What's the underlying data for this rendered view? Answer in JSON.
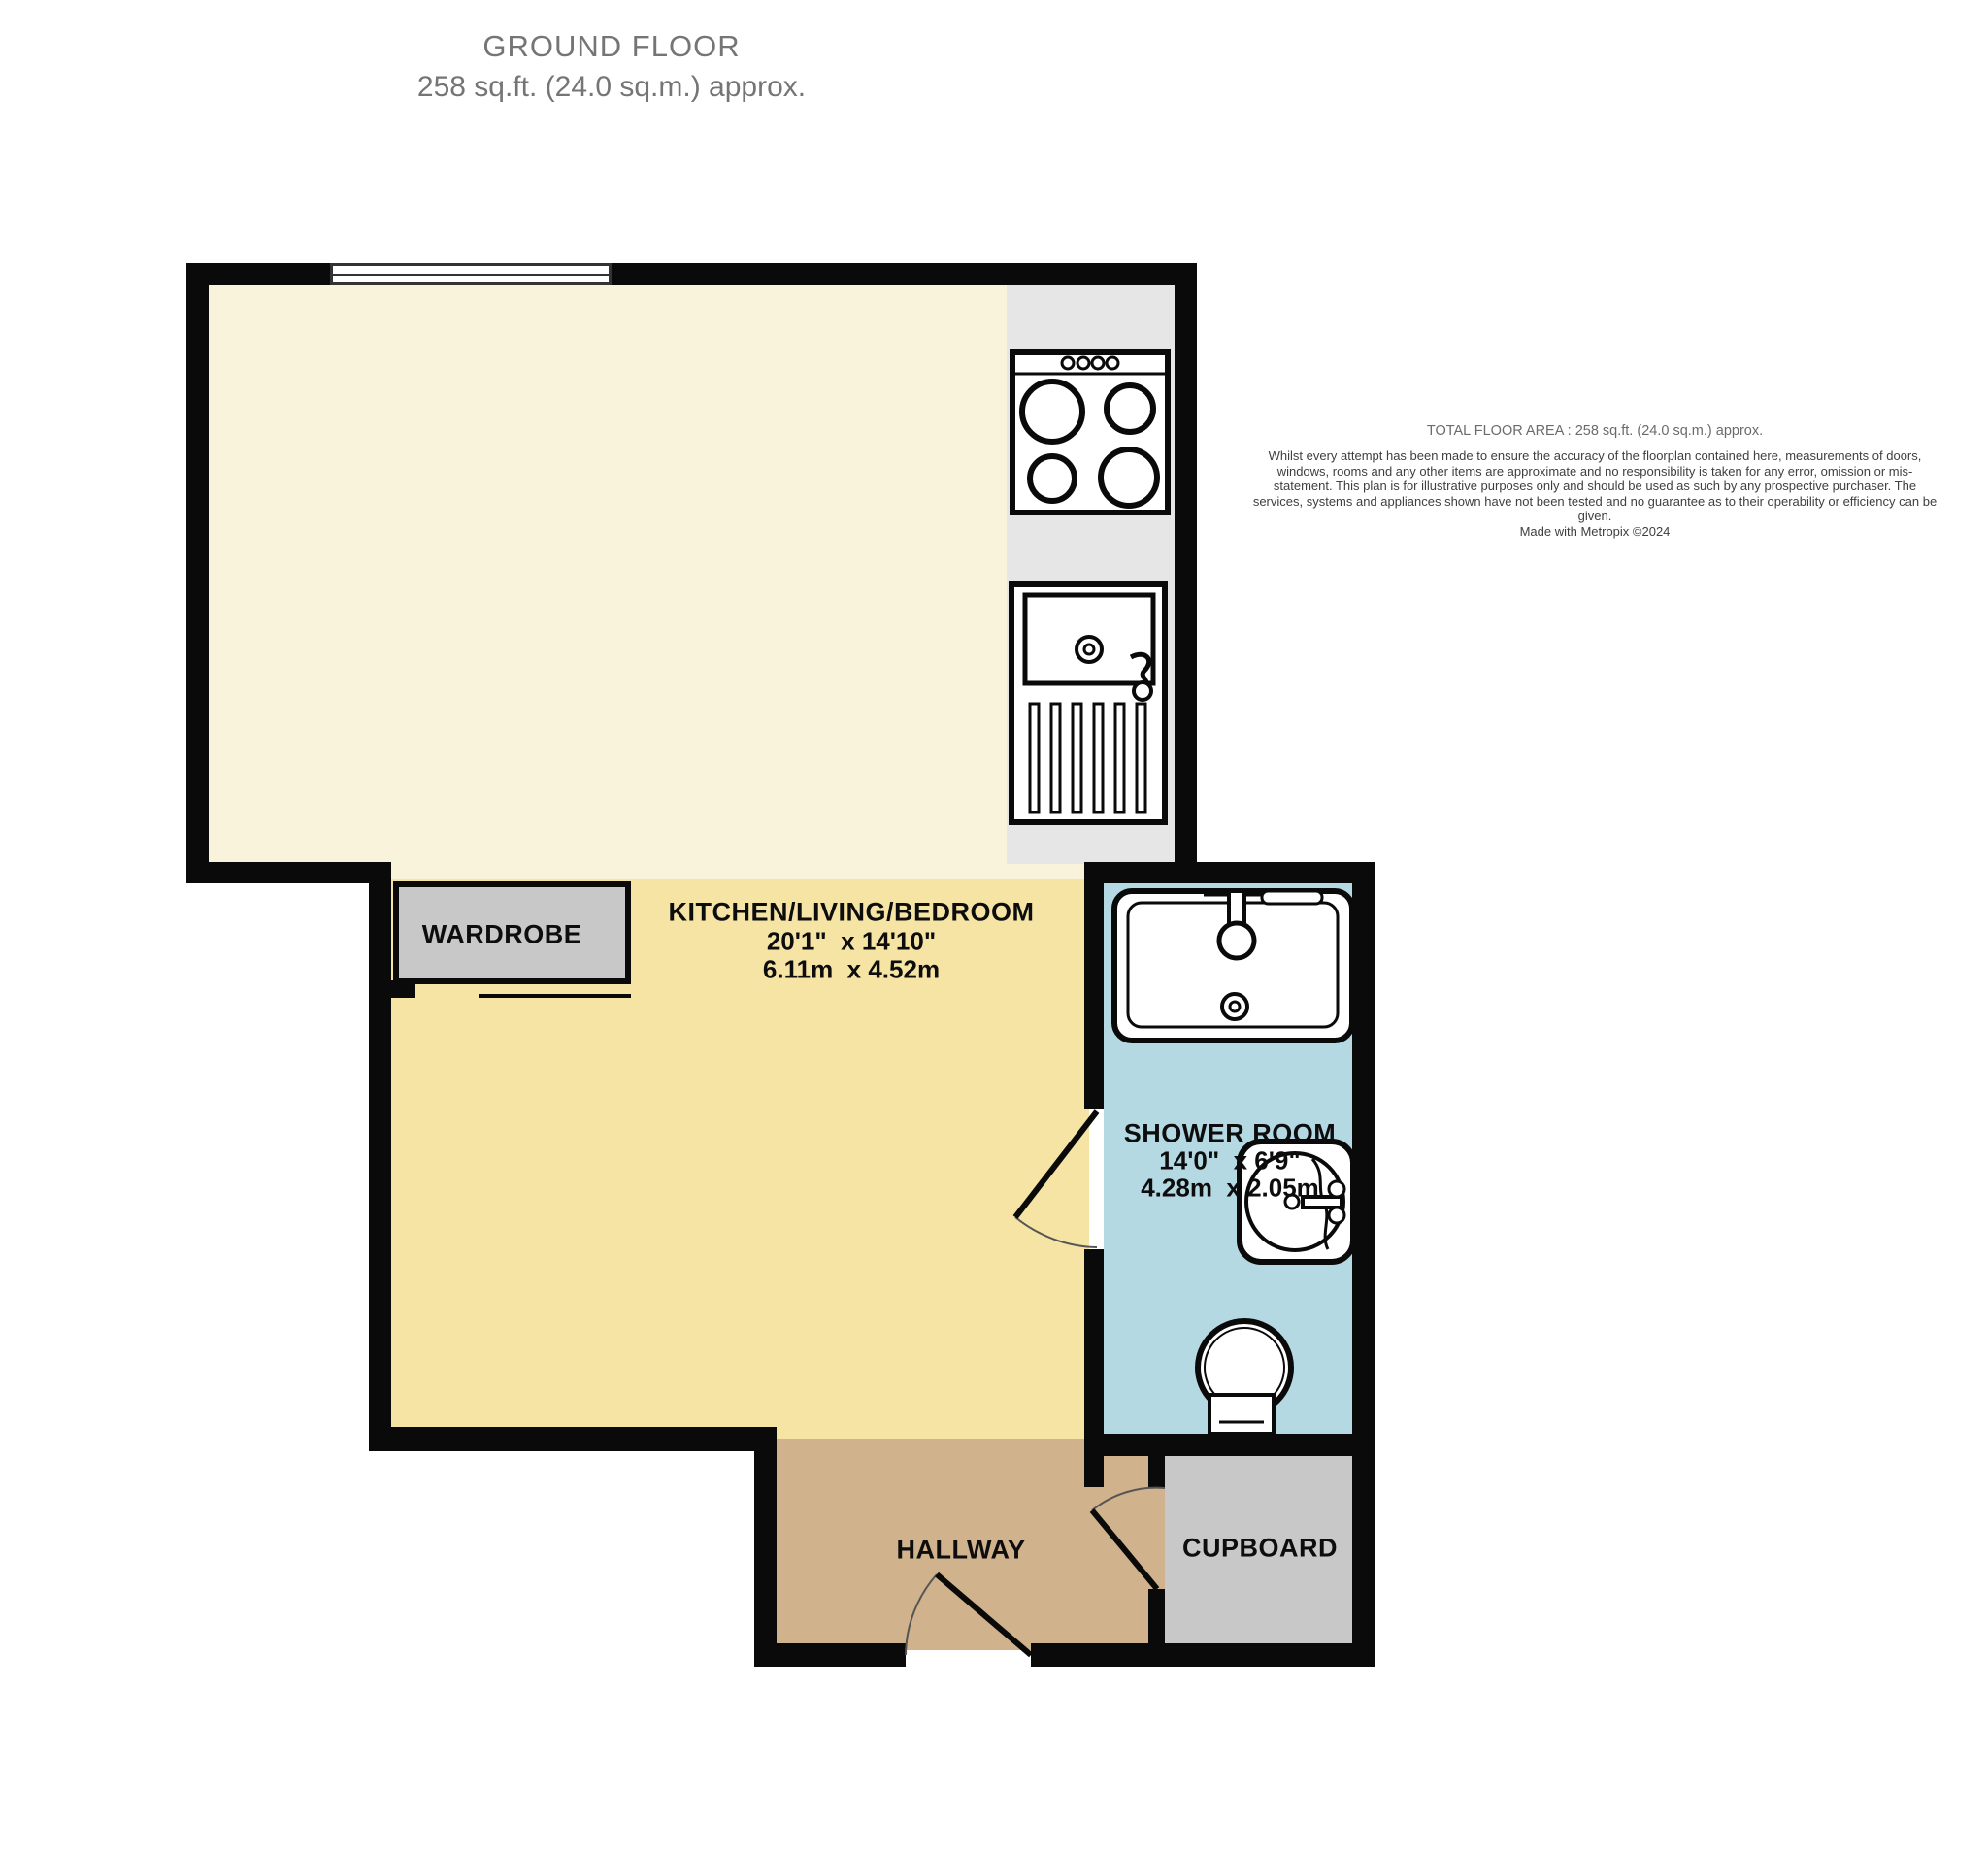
{
  "title": {
    "line1": "GROUND FLOOR",
    "line2": "258 sq.ft. (24.0 sq.m.) approx."
  },
  "disclaimer": {
    "heading": "TOTAL FLOOR AREA : 258 sq.ft. (24.0 sq.m.) approx.",
    "body": "Whilst every attempt has been made to ensure the accuracy of the floorplan contained here, measurements of doors, windows, rooms and any other items are approximate and no responsibility is taken for any error, omission or mis-statement. This plan is for illustrative purposes only and should be used as such by any prospective purchaser. The services, systems and appliances shown have not been tested and no guarantee as to their operability or efficiency can be given.",
    "credit": "Made with Metropix ©2024"
  },
  "rooms": {
    "kitchen_living_bedroom": {
      "name": "KITCHEN/LIVING/BEDROOM",
      "dims_imperial": "20'1\"  x 14'10\"",
      "dims_metric": "6.11m  x 4.52m"
    },
    "shower_room": {
      "name": "SHOWER ROOM",
      "dims_imperial": "14'0\"  x 6'9\"",
      "dims_metric": "4.28m  x 2.05m"
    },
    "wardrobe": {
      "name": "WARDROBE"
    },
    "hallway": {
      "name": "HALLWAY"
    },
    "cupboard": {
      "name": "CUPBOARD"
    }
  },
  "fixtures": [
    "window",
    "stove-hob",
    "kitchen-sink-drainer",
    "bathroom-basin",
    "shower-enclosure",
    "toilet",
    "door-arc-shower",
    "door-arc-cupboard",
    "door-arc-front"
  ],
  "colors": {
    "wall": "#0a0a0a",
    "kitchen_zone": "#faf3dc",
    "living_zone": "#f5e4a4",
    "counter": "#e6e6e6",
    "shower_room": "#b5d9e3",
    "hallway": "#d0b28c",
    "storage_gray": "#c8c8c8",
    "title_text": "#757575",
    "label_text": "#0d0d0d"
  }
}
